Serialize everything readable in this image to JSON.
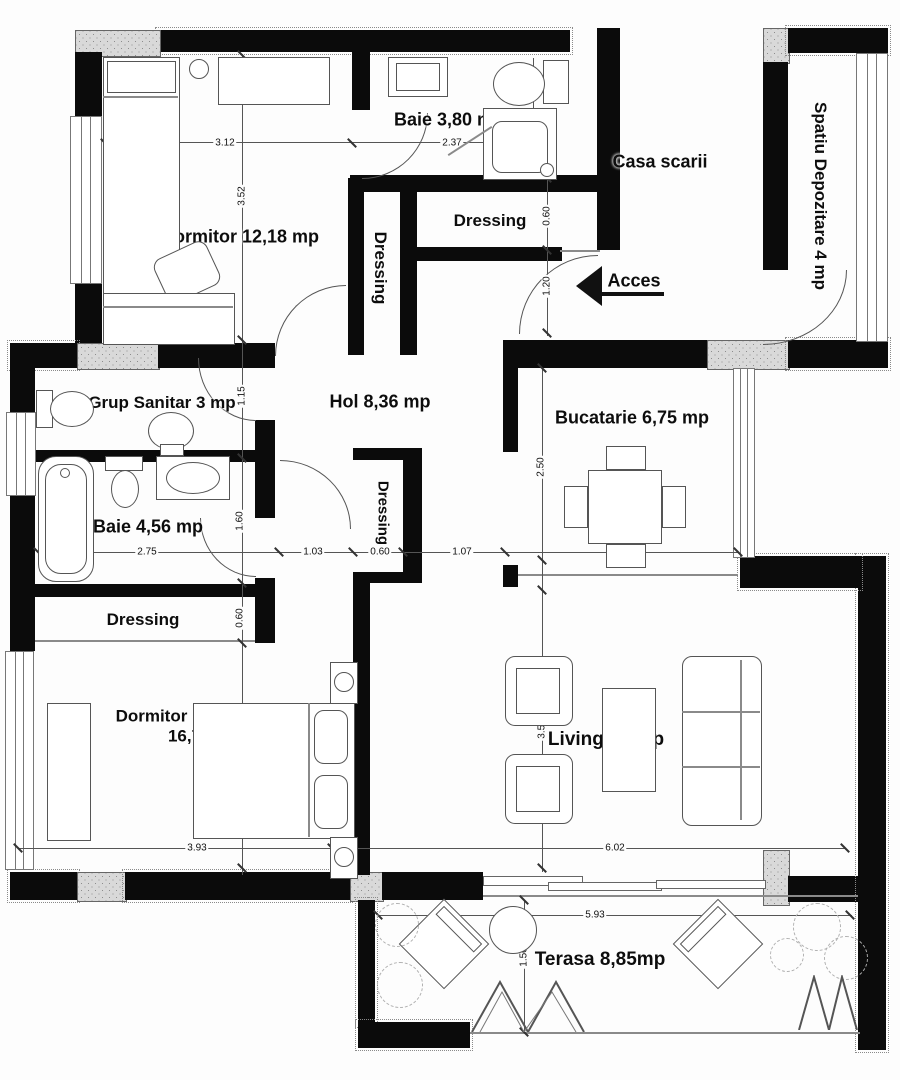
{
  "plan": {
    "rooms": {
      "dormitor": "Dormitor 12,18 mp",
      "baie1": "Baie 3,80 mp",
      "casa_scarii": "Casa scarii",
      "spatiu_depozitare": "Spatiu Depozitare 4 mp",
      "dressing_top": "Dressing",
      "dressing_hall": "Dressing",
      "hol": "Hol 8,36 mp",
      "grup_sanitar": "Grup Sanitar 3 mp",
      "bucatarie": "Bucatarie 6,75 mp",
      "baie2": "Baie 4,56 mp",
      "dressing_mid": "Dressing",
      "dressing_left": "Dressing",
      "dormitor_matrimonial_line1": "Dormitor matrimonial",
      "dormitor_matrimonial_line2": "16,73mp",
      "living": "Living 22 mp",
      "terasa": "Terasa 8,85mp"
    },
    "access_label": "Acces",
    "dimensions": {
      "dormitor_width": "3.12",
      "dormitor_height": "3.52",
      "baie1_width": "2.37",
      "baie1_height": "1.57",
      "vestibule_top": "0.60",
      "entry_opening": "1.20",
      "grup_sanitar_height": "1.15",
      "baie2_width": "2.75",
      "hol_segment": "1.03",
      "dressing_mid_width": "0.60",
      "kitchen_opening": "1.07",
      "bucatarie_width": "2.70",
      "bucatarie_height": "2.50",
      "baie2_height": "1.60",
      "dressing_left_height": "0.60",
      "matrimonial_height": "2.85",
      "living_height": "3.57",
      "matrimonial_width": "3.93",
      "living_width": "6.02",
      "terasa_width": "5.93",
      "terasa_height": "1.50"
    },
    "colors": {
      "wall": "#0b0b0b",
      "line": "#555555",
      "hatch": "#d9d9d9",
      "background": "#fdfdfd",
      "text": "#111111"
    }
  }
}
